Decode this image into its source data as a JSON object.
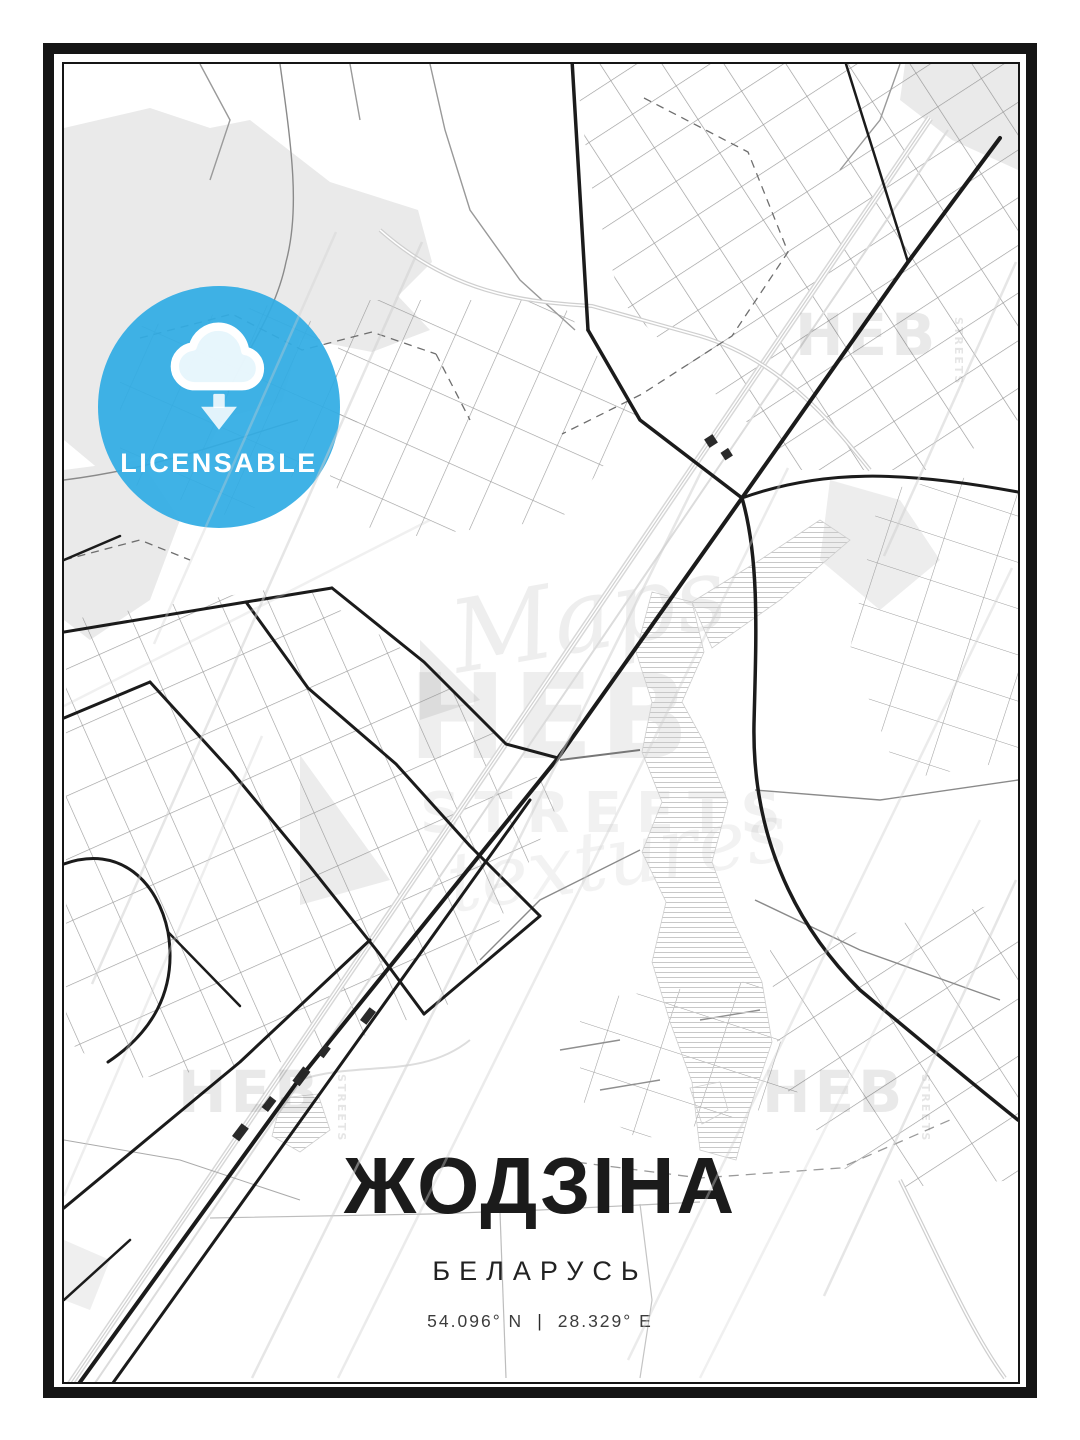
{
  "poster": {
    "badge": {
      "label": "LICENSABLE",
      "color": "#2eace4",
      "icon": "cloud-download"
    },
    "title": "ЖОДЗІНА",
    "subtitle": "БЕЛАРУСЬ",
    "coordinates": {
      "lat": "54.096° N",
      "separator": "|",
      "lon": "28.329° E"
    },
    "watermarks": {
      "script_top": "Maps",
      "brand": "HEB",
      "streets": "STREETS",
      "script_bottom": "textures",
      "corner_brand": "HEB",
      "corner_side": "STREETS"
    },
    "map": {
      "road_color": "#1b1b1b",
      "street_color": "#8a8a8a",
      "landuse_color": "#eaeaea",
      "water_hatch_color": "#c8c8c8",
      "railway_color": "#d8d8d8"
    }
  }
}
